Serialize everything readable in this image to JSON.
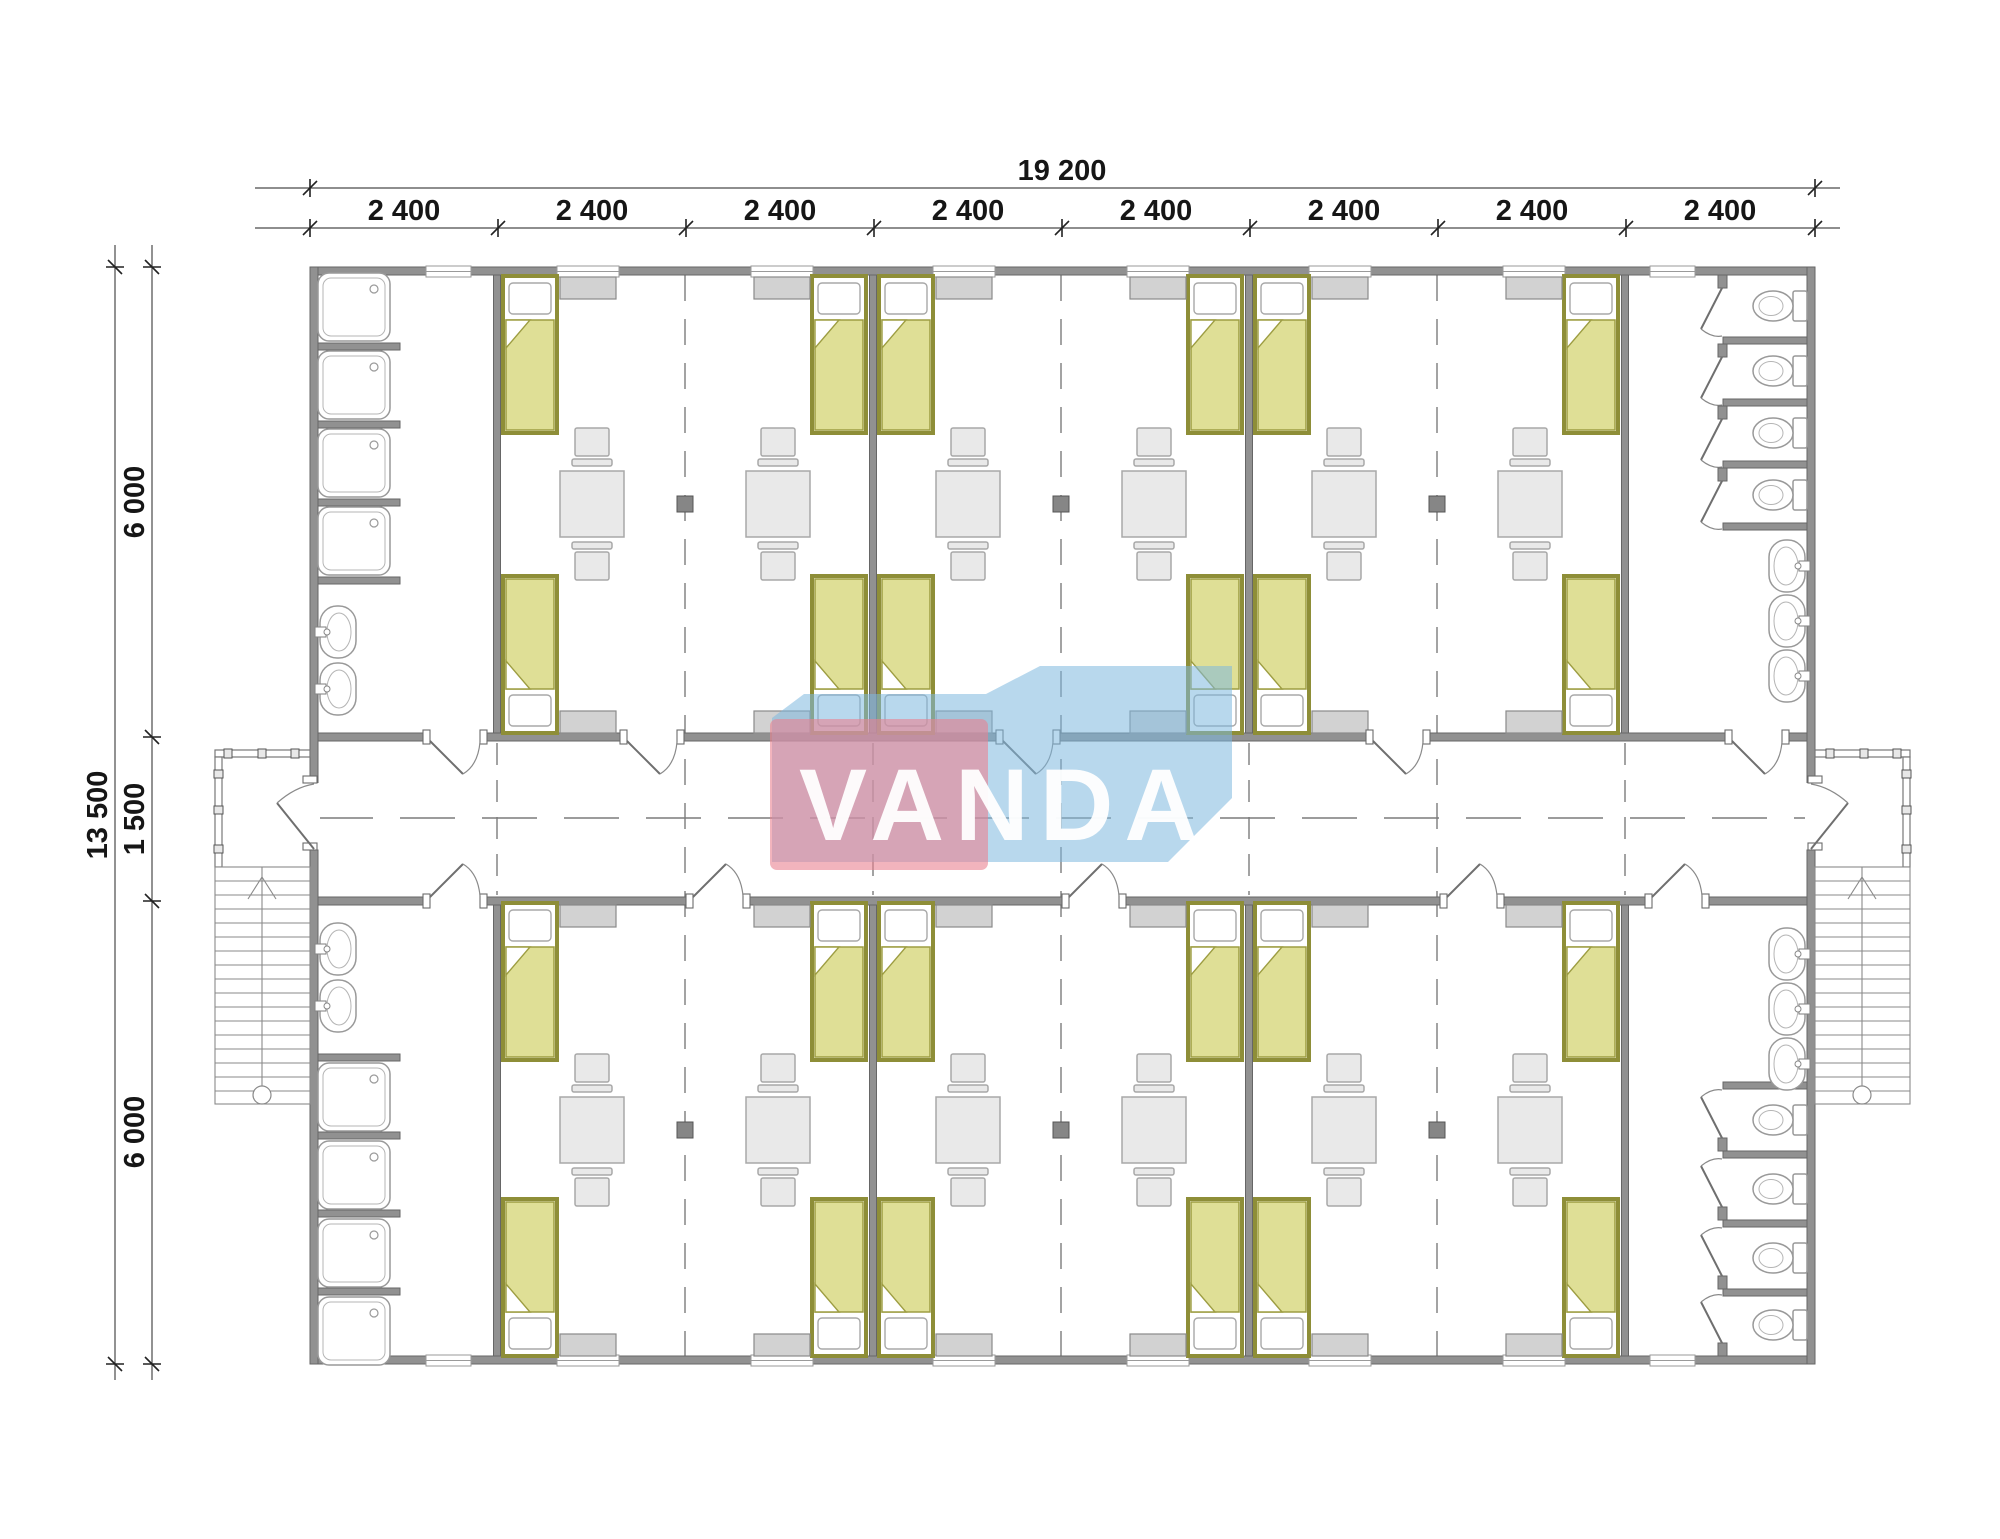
{
  "logo": {
    "text": "VANDA"
  },
  "dimensions": {
    "overall_width": "19 200",
    "width_segments": [
      "2 400",
      "2 400",
      "2 400",
      "2 400",
      "2 400",
      "2 400",
      "2 400",
      "2 400"
    ],
    "overall_height": "13 500",
    "height_segments": [
      "6 000",
      "1 500",
      "6 000"
    ]
  },
  "colors": {
    "wall": "#919191",
    "bed_frame": "#8e8e38",
    "bed_blanket": "#dfdf96",
    "furniture": "#e9e9e9",
    "cabinet": "#d2d2d2",
    "logo_red": "#ea8291",
    "logo_blue": "#7db8de"
  }
}
